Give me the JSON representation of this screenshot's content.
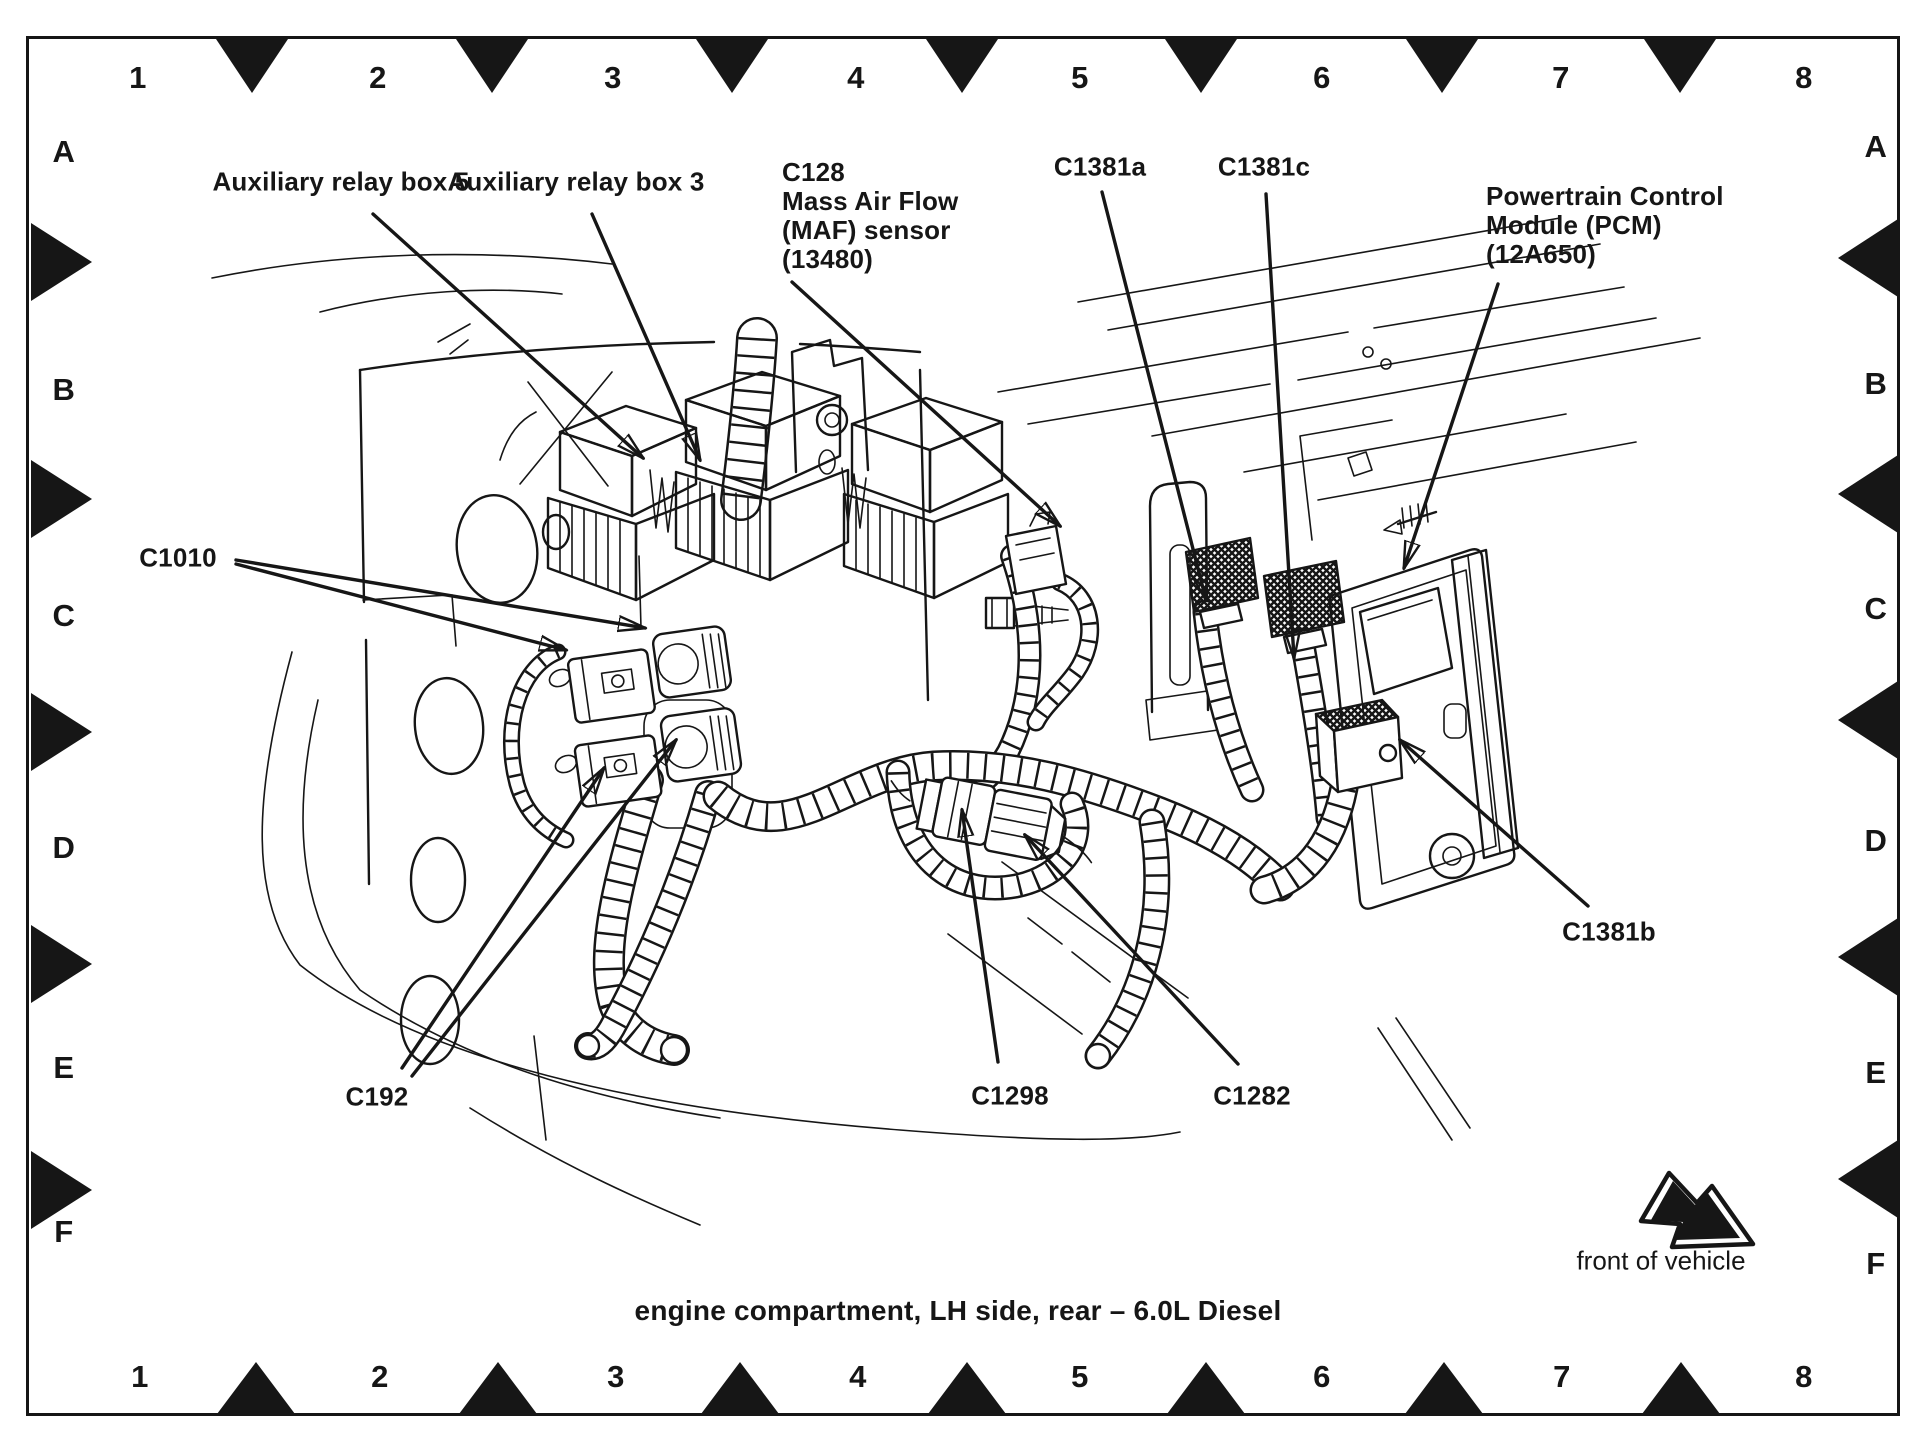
{
  "page": {
    "type": "service-manual connector location view",
    "caption": "engine compartment, LH side, rear – 6.0L Diesel",
    "direction_indicator": "front of vehicle"
  },
  "grid": {
    "top_numbers": [
      "1",
      "2",
      "3",
      "4",
      "5",
      "6",
      "7",
      "8"
    ],
    "bottom_numbers": [
      "1",
      "2",
      "3",
      "4",
      "5",
      "6",
      "7",
      "8"
    ],
    "left_letters": [
      "A",
      "B",
      "C",
      "D",
      "E",
      "F"
    ],
    "right_letters": [
      "A",
      "B",
      "C",
      "D",
      "E",
      "F"
    ]
  },
  "labels": {
    "aux5": "Auxiliary relay box 5",
    "aux3": "Auxiliary relay box 3",
    "c128_lines": [
      "C128",
      "Mass Air Flow",
      "(MAF) sensor",
      "(13480)"
    ],
    "c1381a": "C1381a",
    "c1381c": "C1381c",
    "pcm_lines": [
      "Powertrain Control",
      "Module (PCM)",
      "(12A650)"
    ],
    "c1010": "C1010",
    "c192": "C192",
    "c1298": "C1298",
    "c1282": "C1282",
    "c1381b": "C1381b"
  },
  "icons": {
    "front_of_vehicle_arrow": "thick outlined arrow pointing down-right",
    "leader_arrowheads": "solid triangular arrowheads on callout leader lines",
    "registration_triangles": "solid black alignment triangles on all four frame edges"
  },
  "colors": {
    "ink": "#161616",
    "paper": "#ffffff"
  }
}
